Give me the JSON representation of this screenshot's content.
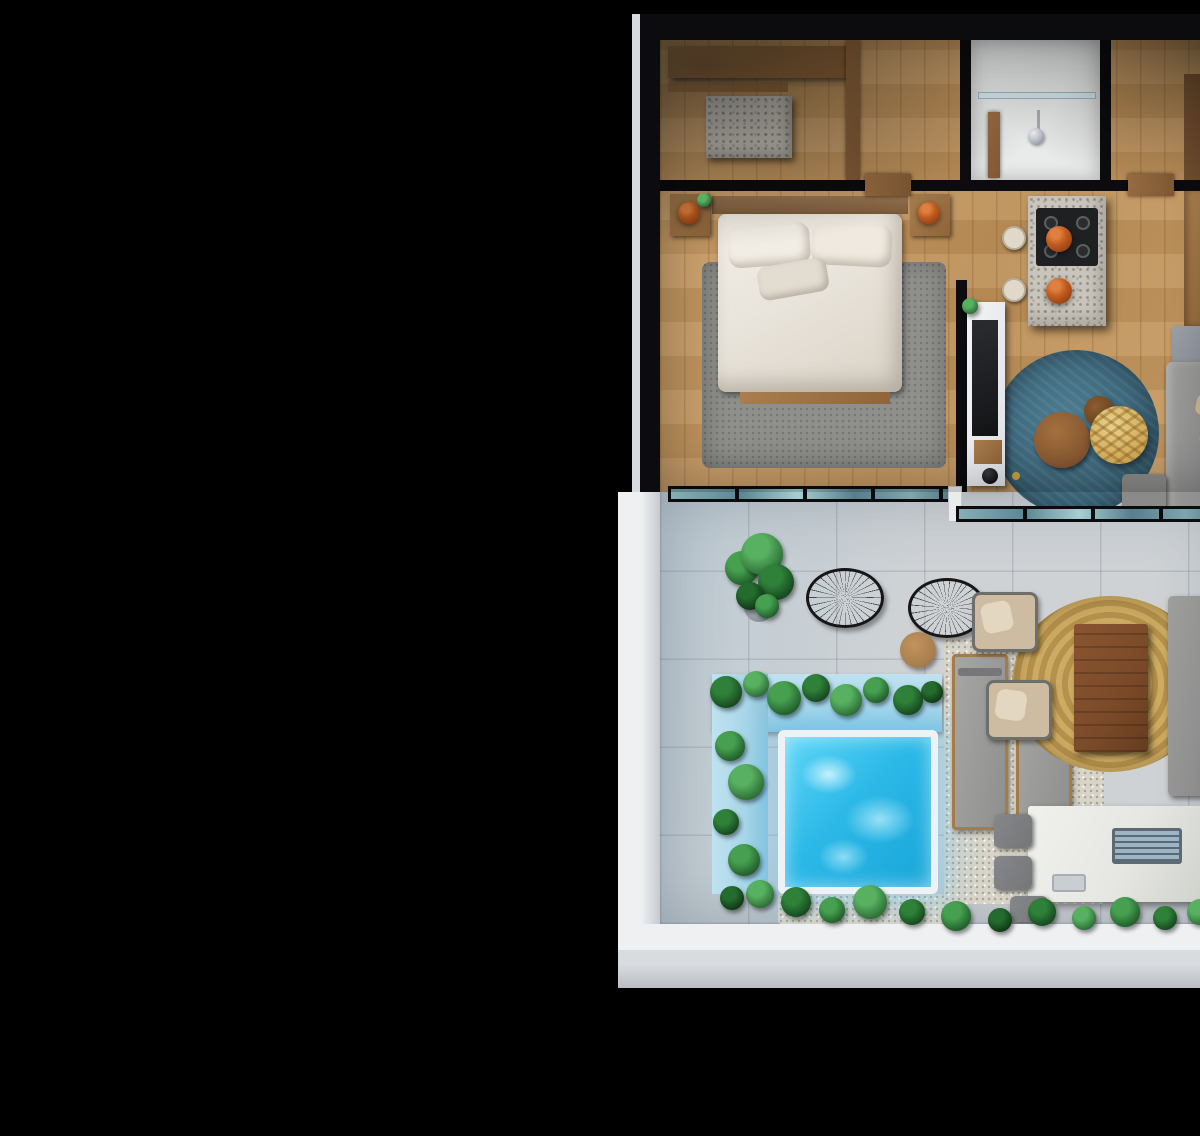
{
  "meta": {
    "description": "3D isometric render of a one-bedroom apartment floor plan with terrace and plunge pool on a black background",
    "visible_text": "none"
  },
  "palette": {
    "bg": "#000000",
    "wall_black": "#0c0c0e",
    "wall_white": "#eef0f2",
    "wall_gray": "#9aa5b6",
    "wood_floor": "#cda26b",
    "wood_dark": "#7d5835",
    "wood_mid": "#a97f4f",
    "wood_door": "#9a6e42",
    "terrazzo": "#c9c5bc",
    "cooktop": "#1f2022",
    "terracotta": "#c05a1e",
    "bed_white": "#e9e4db",
    "rug_gray": "#8f8f8c",
    "rug_blue": "#3a6478",
    "table_wood": "#8b5a33",
    "rattan": "#d4ad5c",
    "sofa_gray": "#909090",
    "pillow_beige": "#c9b493",
    "glass_teal": "#5b8792",
    "terrace_floor": "#ced2d5",
    "pool_blue": "#2cb9e8",
    "pool_wall": "#a9d6e8",
    "gravel": "#d8d4c8",
    "jute": "#c9a85f",
    "outdoor_table": "#7a4a28",
    "wicker": "#cdbba2",
    "white_counter": "#e6e7e3",
    "grill": "#9db4c2",
    "chair_gray": "#747678",
    "bathroom_floor": "#e9eaea"
  },
  "scene": {
    "rooms": [
      "walk-in-closet",
      "bathroom",
      "entry-hall",
      "bedroom",
      "kitchen",
      "living-room",
      "terrace",
      "plunge-pool"
    ],
    "furniture": [
      "double-bed",
      "nightstands-with-terracotta-lamps",
      "wood-headboard",
      "tv-media-wall",
      "terrazzo-kitchen-island",
      "cooktop",
      "bar-stools",
      "pendant-lamps",
      "fridge",
      "blue-round-rug",
      "round-coffee-tables",
      "rattan-pendant-lamp",
      "gray-sofa",
      "acapulco-wire-chairs",
      "side-table",
      "potted-palm",
      "sun-loungers",
      "jute-rug",
      "outdoor-wood-table",
      "wicker-armchairs",
      "outdoor-sofa",
      "outdoor-kitchen-with-grill-and-sink",
      "outdoor-chairs",
      "shower-glass",
      "closet-shelving"
    ],
    "green_tones": [
      [
        "#46a050",
        "#1e5a28"
      ],
      [
        "#2f8039",
        "#14451d"
      ],
      [
        "#58b161",
        "#2a6a34"
      ],
      [
        "#246b2e",
        "#0e3415"
      ]
    ],
    "plants": [
      {
        "x": 82,
        "y": 528,
        "r": 17,
        "t": 0
      },
      {
        "x": 102,
        "y": 514,
        "r": 21,
        "t": 2
      },
      {
        "x": 116,
        "y": 542,
        "r": 18,
        "t": 1
      },
      {
        "x": 90,
        "y": 556,
        "r": 14,
        "t": 3
      },
      {
        "x": 107,
        "y": 566,
        "r": 12,
        "t": 0
      },
      {
        "x": 66,
        "y": 652,
        "r": 16,
        "t": 1
      },
      {
        "x": 96,
        "y": 644,
        "r": 13,
        "t": 2
      },
      {
        "x": 124,
        "y": 658,
        "r": 17,
        "t": 0
      },
      {
        "x": 156,
        "y": 648,
        "r": 14,
        "t": 1
      },
      {
        "x": 186,
        "y": 660,
        "r": 16,
        "t": 2
      },
      {
        "x": 216,
        "y": 650,
        "r": 13,
        "t": 0
      },
      {
        "x": 248,
        "y": 660,
        "r": 15,
        "t": 1
      },
      {
        "x": 272,
        "y": 652,
        "r": 11,
        "t": 3
      },
      {
        "x": 70,
        "y": 706,
        "r": 15,
        "t": 0
      },
      {
        "x": 86,
        "y": 742,
        "r": 18,
        "t": 2
      },
      {
        "x": 66,
        "y": 782,
        "r": 13,
        "t": 1
      },
      {
        "x": 84,
        "y": 820,
        "r": 16,
        "t": 0
      },
      {
        "x": 100,
        "y": 854,
        "r": 14,
        "t": 2
      },
      {
        "x": 72,
        "y": 858,
        "r": 12,
        "t": 3
      },
      {
        "x": 136,
        "y": 862,
        "r": 15,
        "t": 1
      },
      {
        "x": 172,
        "y": 870,
        "r": 13,
        "t": 0
      },
      {
        "x": 210,
        "y": 862,
        "r": 17,
        "t": 2
      },
      {
        "x": 252,
        "y": 872,
        "r": 13,
        "t": 1
      },
      {
        "x": 296,
        "y": 876,
        "r": 15,
        "t": 0
      },
      {
        "x": 340,
        "y": 880,
        "r": 12,
        "t": 3
      },
      {
        "x": 382,
        "y": 872,
        "r": 14,
        "t": 1
      },
      {
        "x": 424,
        "y": 878,
        "r": 12,
        "t": 2
      },
      {
        "x": 465,
        "y": 872,
        "r": 15,
        "t": 0
      },
      {
        "x": 505,
        "y": 878,
        "r": 12,
        "t": 1
      },
      {
        "x": 540,
        "y": 872,
        "r": 13,
        "t": 2
      },
      {
        "x": 310,
        "y": 266,
        "r": 8,
        "t": 2
      },
      {
        "x": 44,
        "y": 160,
        "r": 7,
        "t": 2
      }
    ]
  }
}
